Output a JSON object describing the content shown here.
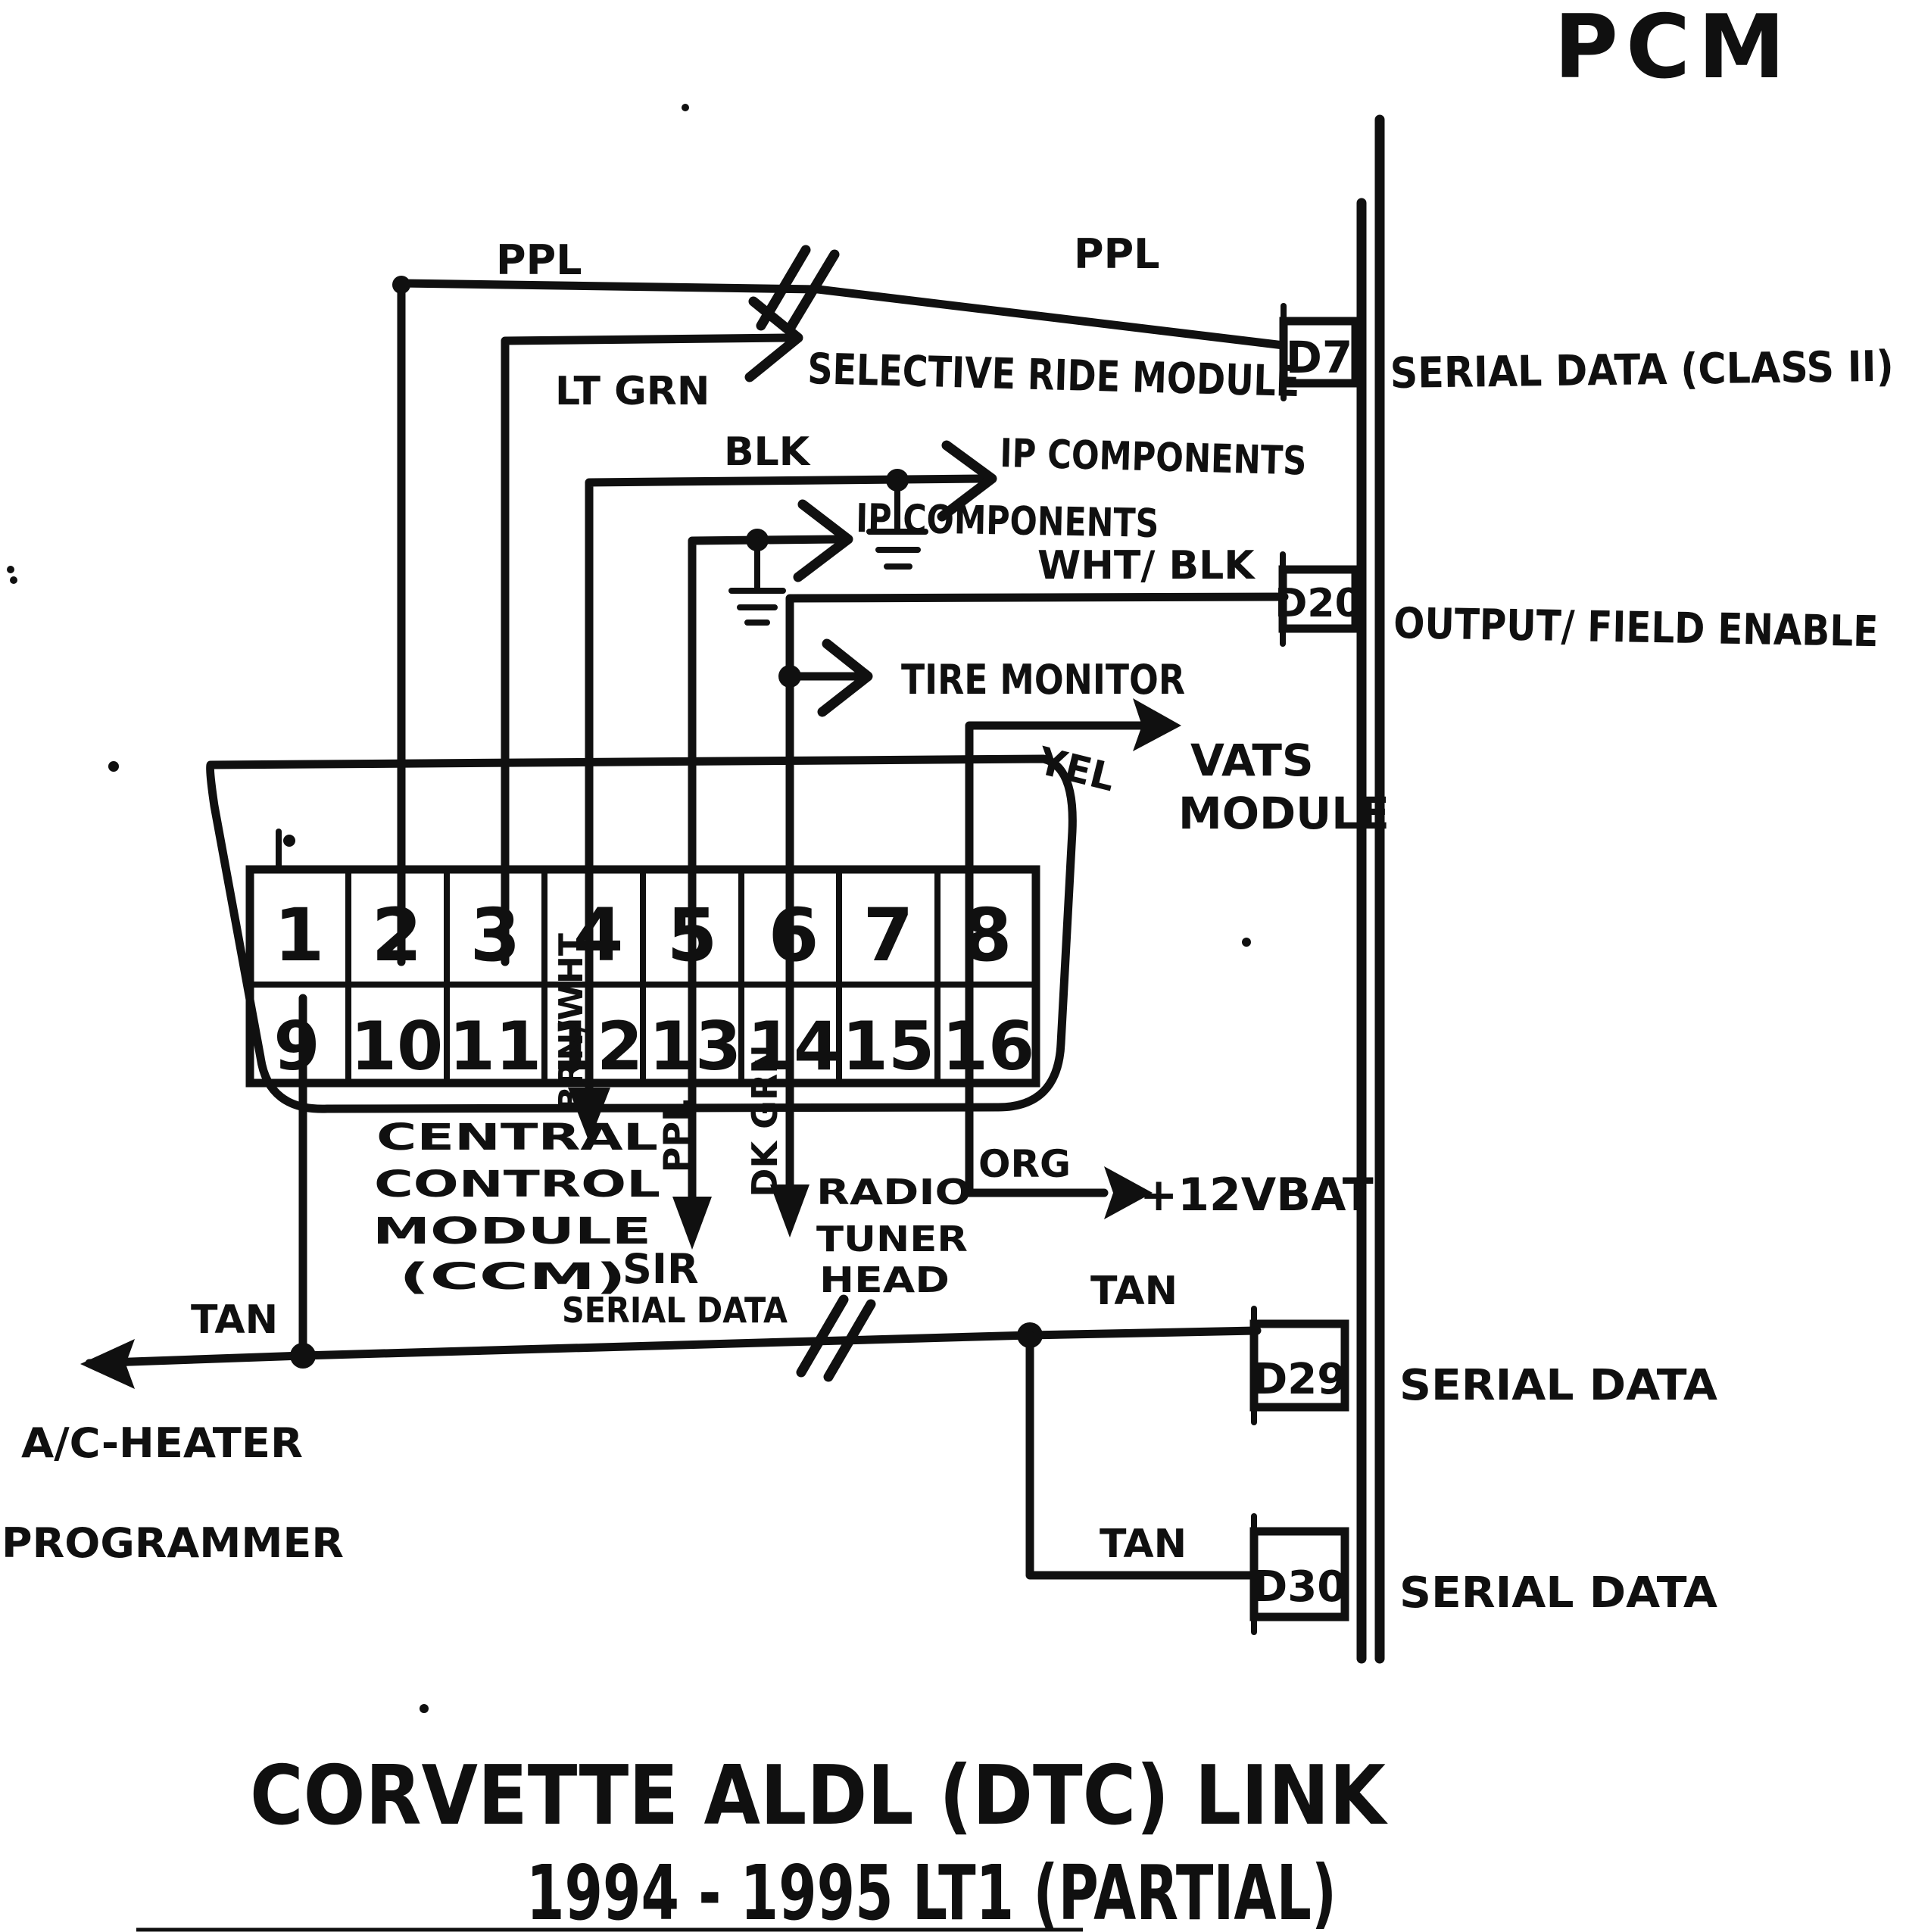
{
  "pcm": {
    "label": "PCM"
  },
  "title": {
    "line1": "CORVETTE ALDL (DTC) LINK",
    "line2": "1994 - 1995 LT1  (PARTIAL)"
  },
  "connector": {
    "pins": [
      "1",
      "2",
      "3",
      "4",
      "5",
      "6",
      "7",
      "8",
      "9",
      "10",
      "11",
      "12",
      "13",
      "14",
      "15",
      "16"
    ]
  },
  "pcm_terminals": [
    {
      "id": "D7",
      "signal": "SERIAL DATA (CLASS II)"
    },
    {
      "id": "D20",
      "signal": "OUTPUT/ FIELD ENABLE"
    },
    {
      "id": "D29",
      "signal": "SERIAL DATA"
    },
    {
      "id": "D30",
      "signal": "SERIAL DATA"
    }
  ],
  "wires": {
    "ppl_left": "PPL",
    "ppl_right": "PPL",
    "lt_grn": "LT GRN",
    "blk": "BLK",
    "wht_blk": "WHT/ BLK",
    "yel": "YEL",
    "org": "ORG",
    "tan_ac": "TAN",
    "tan_d29": "TAN",
    "tan_d30": "TAN",
    "brn_wht": "BRN/WHT",
    "ppl_sir": "PPL",
    "dk_grn": "DK GRN"
  },
  "modules": {
    "selective_ride": "SELECTIVE RIDE MODULE",
    "ip_components_1": "IP COMPONENTS",
    "ip_components_2": "IP COMPONENTS",
    "tire_monitor": "TIRE MONITOR",
    "vats_line1": "VATS",
    "vats_line2": "MODULE",
    "battery": "+12VBAT",
    "ccm_line1": "CENTRAL",
    "ccm_line2": "CONTROL",
    "ccm_line3": "MODULE",
    "ccm_line4": "(CCM)",
    "sir_line1": "SIR",
    "sir_line2": "SERIAL DATA",
    "radio_line1": "RADIO",
    "radio_line2": "TUNER",
    "radio_line3": "HEAD",
    "ac_line1": "A/C-HEATER",
    "ac_line2": "PROGRAMMER"
  }
}
